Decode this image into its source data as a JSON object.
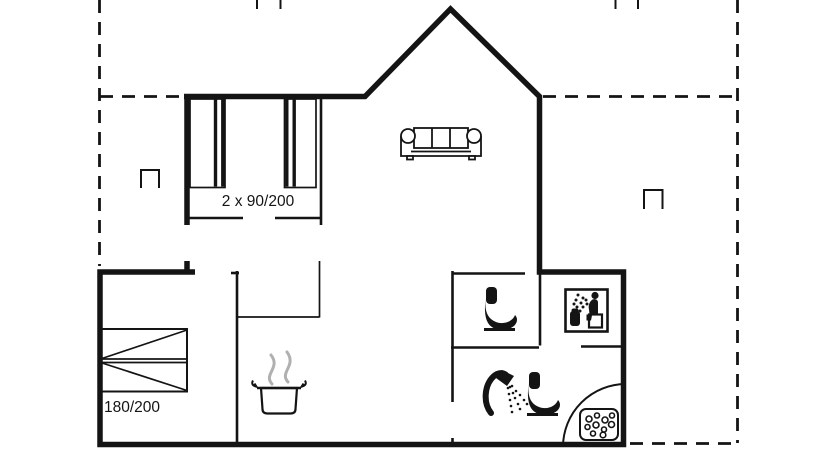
{
  "labels": {
    "bunk_beds": "2 x 90/200",
    "double_bed": "180/200"
  },
  "colors": {
    "line": "#141414",
    "steam": "#b0b0b0",
    "background": "#ffffff"
  },
  "icons": [
    "roof-overhang-dashed-outline",
    "gable-roof-line",
    "bunk-beds-icon",
    "double-bed-icon",
    "sofa-icon",
    "cooking-pot-icon",
    "steam-icon",
    "toilet-icon-wc",
    "toilet-icon-bathroom",
    "shower-head-icon",
    "sauna-icon",
    "corner-shower-tray-icon",
    "vent-symbol"
  ]
}
